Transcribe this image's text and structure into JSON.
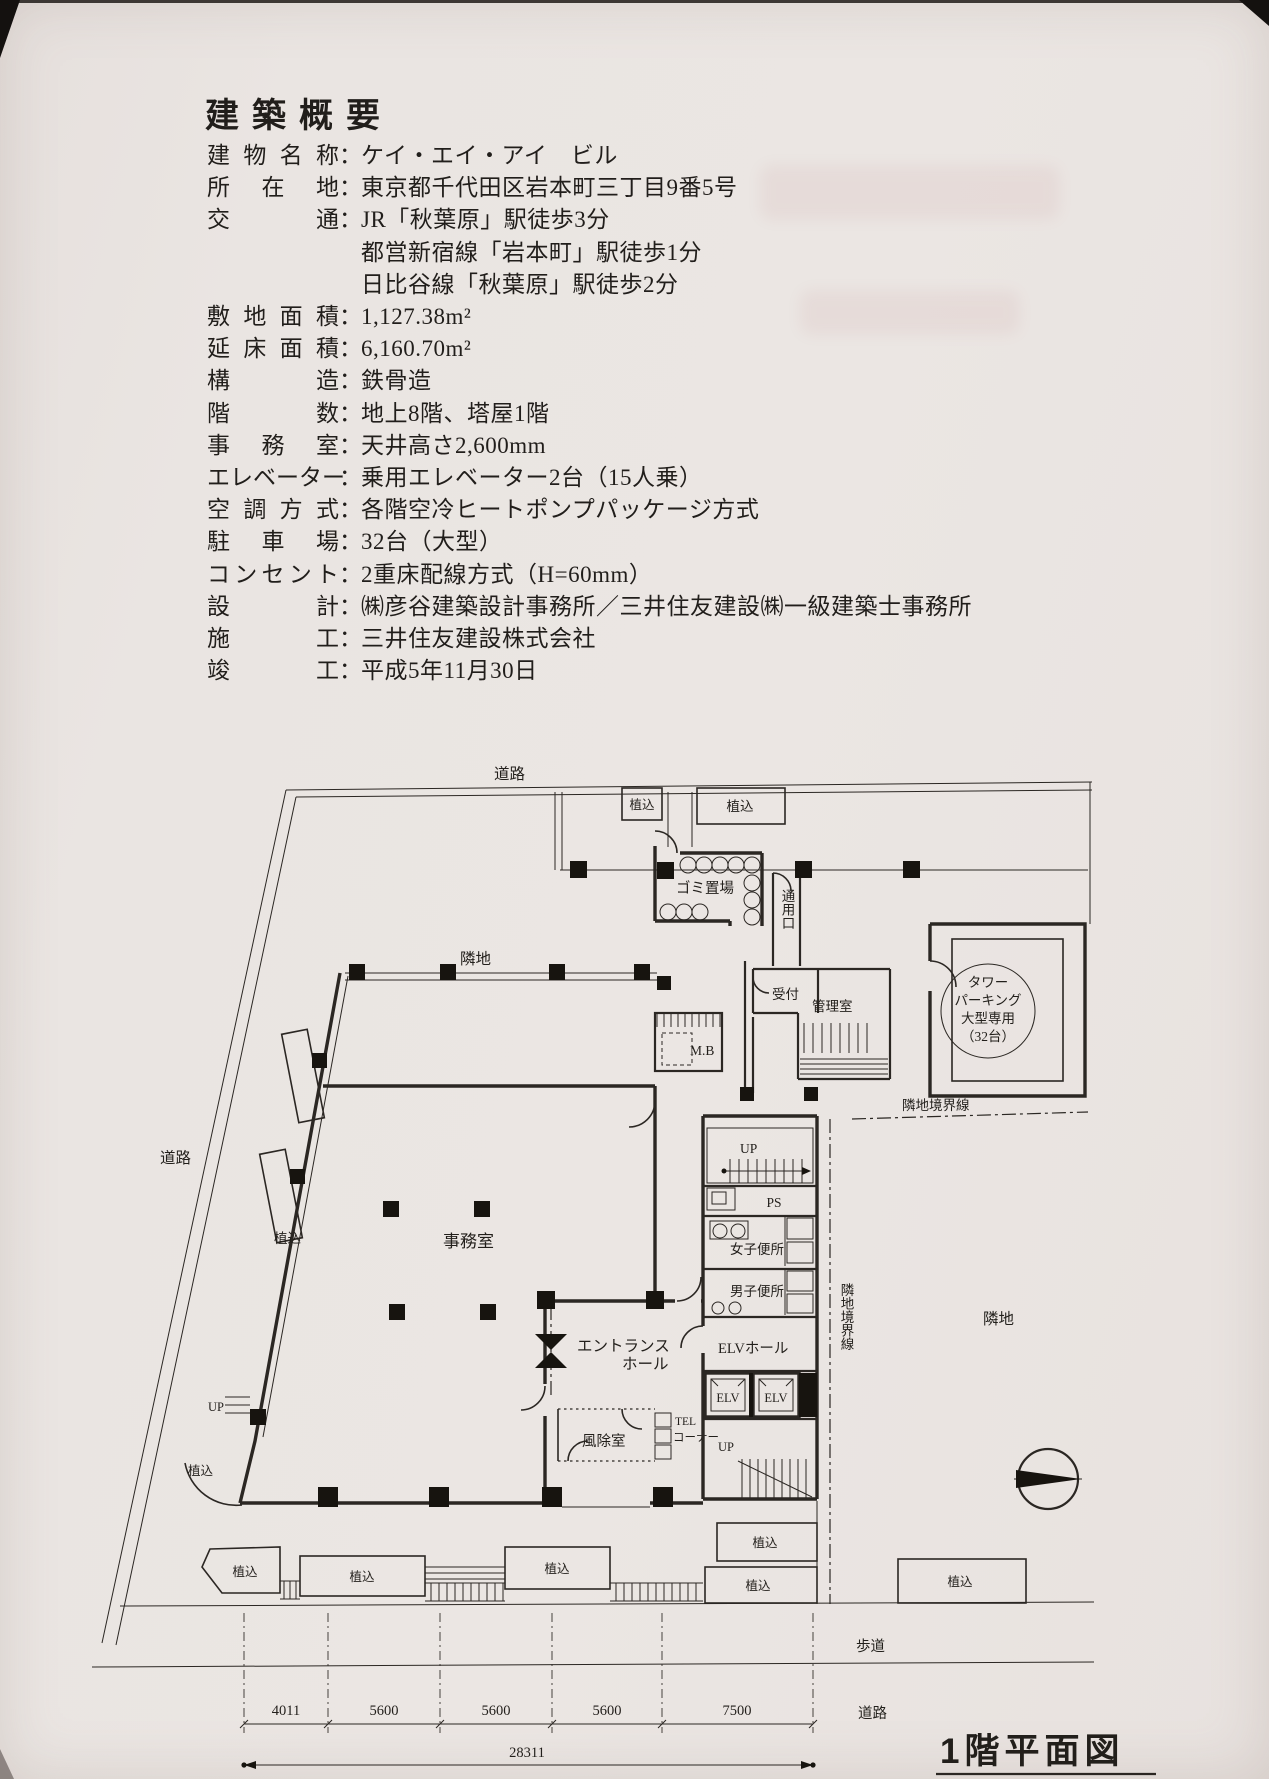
{
  "document": {
    "title": "建築概要",
    "sep": "："
  },
  "specs": [
    {
      "label": "建物名称",
      "value": "ケイ・エイ・アイ　ビル"
    },
    {
      "label": "所在地",
      "value": "東京都千代田区岩本町三丁目9番5号"
    },
    {
      "label": "交通",
      "value": "JR「秋葉原」駅徒歩3分"
    },
    {
      "label": "",
      "value": "都営新宿線「岩本町」駅徒歩1分"
    },
    {
      "label": "",
      "value": "日比谷線「秋葉原」駅徒歩2分"
    },
    {
      "label": "敷地面積",
      "value": "1,127.38m²"
    },
    {
      "label": "延床面積",
      "value": "6,160.70m²"
    },
    {
      "label": "構造",
      "value": "鉄骨造"
    },
    {
      "label": "階数",
      "value": "地上8階、塔屋1階"
    },
    {
      "label": "事務室",
      "value": "天井高さ2,600mm"
    },
    {
      "label": "エレベーター",
      "value": "乗用エレベーター2台（15人乗）"
    },
    {
      "label": "空調方式",
      "value": "各階空冷ヒートポンプパッケージ方式"
    },
    {
      "label": "駐車場",
      "value": "32台（大型）"
    },
    {
      "label": "コンセント",
      "value": "2重床配線方式（H=60mm）"
    },
    {
      "label": "設計",
      "value": "㈱彦谷建築設計事務所／三井住友建設㈱一級建築士事務所"
    },
    {
      "label": "施工",
      "value": "三井住友建設株式会社"
    },
    {
      "label": "竣工",
      "value": "平成5年11月30日"
    }
  ],
  "plan": {
    "road": "道路",
    "sidewalk": "歩道",
    "neighbor": "隣地",
    "boundary": "隣地境界線",
    "planting": "植込",
    "garbage": "ゴミ置場",
    "service_entrance": "通用口",
    "reception": "受付",
    "manager_room": "管理室",
    "tower_parking": [
      "タワー",
      "パーキング",
      "大型専用",
      "（32台）"
    ],
    "mb": "M.B",
    "up": "UP",
    "ps": "PS",
    "womens_wc": "女子便所",
    "mens_wc": "男子便所",
    "elv_hall": "ELVホール",
    "elv": "ELV",
    "tel_line1": "TEL",
    "tel_line2": "コーナー",
    "entrance_line1": "エントランス",
    "entrance_line2": "ホール",
    "windbreak_room": "風除室",
    "office": "事務室",
    "dims": [
      "4011",
      "5600",
      "5600",
      "5600",
      "7500"
    ],
    "dims_total": "28311",
    "title": "1階平面図"
  }
}
